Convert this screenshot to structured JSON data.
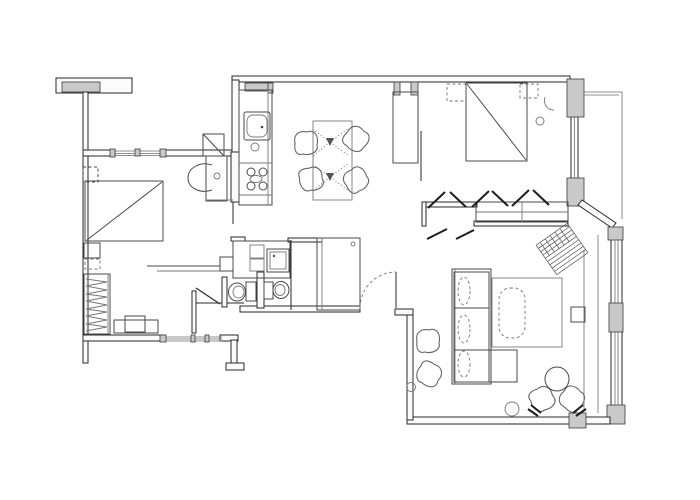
{
  "document": {
    "type": "architectural floor plan",
    "title": "Apartment floor plan — black line drawing on white",
    "text_labels": []
  },
  "canvas": {
    "width": 700,
    "height": 500,
    "background": "#ffffff"
  },
  "palette": {
    "wall_line": "#2a2a2a",
    "wall_fill": "#fbfbfb",
    "block_fill": "#c9c9c9",
    "furniture_line": "#4a4a4a",
    "soft_line": "#777777",
    "hatch_line": "#555555"
  },
  "rooms": [
    {
      "name": "bedroom-left",
      "furniture": [
        "double bed with diagonal throw",
        "nightstand top",
        "nightstand bottom",
        "wardrobe with hanging rail",
        "desk",
        "desk chair",
        "wall shelf"
      ]
    },
    {
      "name": "bathroom",
      "furniture": [
        "washbasin on counter",
        "shower / door square"
      ]
    },
    {
      "name": "wc-left",
      "furniture": [
        "toilet",
        "door leaf"
      ]
    },
    {
      "name": "wc-right",
      "furniture": [
        "toilet"
      ]
    },
    {
      "name": "laundry-unit",
      "furniture": [
        "washing machine",
        "stacked appliances"
      ]
    },
    {
      "name": "kitchen",
      "furniture": [
        "counter run",
        "sink",
        "cooktop 4 burners"
      ]
    },
    {
      "name": "dining",
      "furniture": [
        "table for four",
        "chair x4",
        "twin pedestal bases"
      ]
    },
    {
      "name": "bedroom-right",
      "furniture": [
        "double bed with diagonal throw",
        "pillow x2",
        "armchair",
        "side pouf",
        "tall wardrobe"
      ]
    },
    {
      "name": "walk-in-closet",
      "furniture": [
        "dresser run",
        "clothes-hanger marks"
      ]
    },
    {
      "name": "hallway",
      "furniture": [
        "tall cabinet",
        "entry door with swing arc"
      ]
    },
    {
      "name": "living-room",
      "furniture": [
        "three-seat sofa with chaise",
        "rug",
        "coffee table",
        "tv unit",
        "round table",
        "swivel chair x2",
        "pouf",
        "plant x2",
        "hatched floor mat"
      ]
    }
  ],
  "openings": {
    "windows": [
      "bedroom-left top",
      "bedroom-left bottom",
      "kitchen top ledge",
      "bedroom-right east",
      "living-room east upper",
      "living-room east lower"
    ],
    "doors": [
      "wc-left swing",
      "hall-to-kitchen dashed swing arc"
    ]
  }
}
